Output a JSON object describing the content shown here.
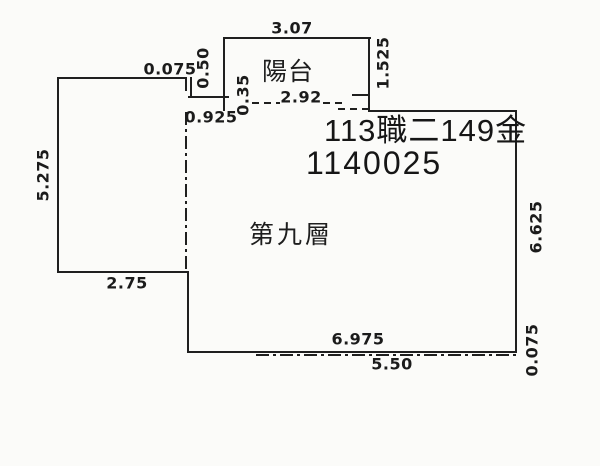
{
  "rooms": {
    "balcony": "陽台",
    "main_floor": "第九層"
  },
  "stamp": {
    "line1": "113職二149金",
    "line2": "1140025"
  },
  "dimensions": {
    "balcony_width": "3.07",
    "balcony_height": "1.525",
    "balcony_inner_width": "2.92",
    "top_left_offset": "0.075",
    "step_height": "0.50",
    "wall_gap": "0.35",
    "left_inset": "0.925",
    "annex_height": "5.275",
    "annex_width": "2.75",
    "main_bottom_width": "6.975",
    "boundary_bottom_width": "5.50",
    "main_right_height": "6.625",
    "bottom_right_offset": "0.075"
  },
  "colors": {
    "line": "#1f1f1f",
    "paper": "#fbfbf9",
    "text": "#1a1a1a"
  }
}
